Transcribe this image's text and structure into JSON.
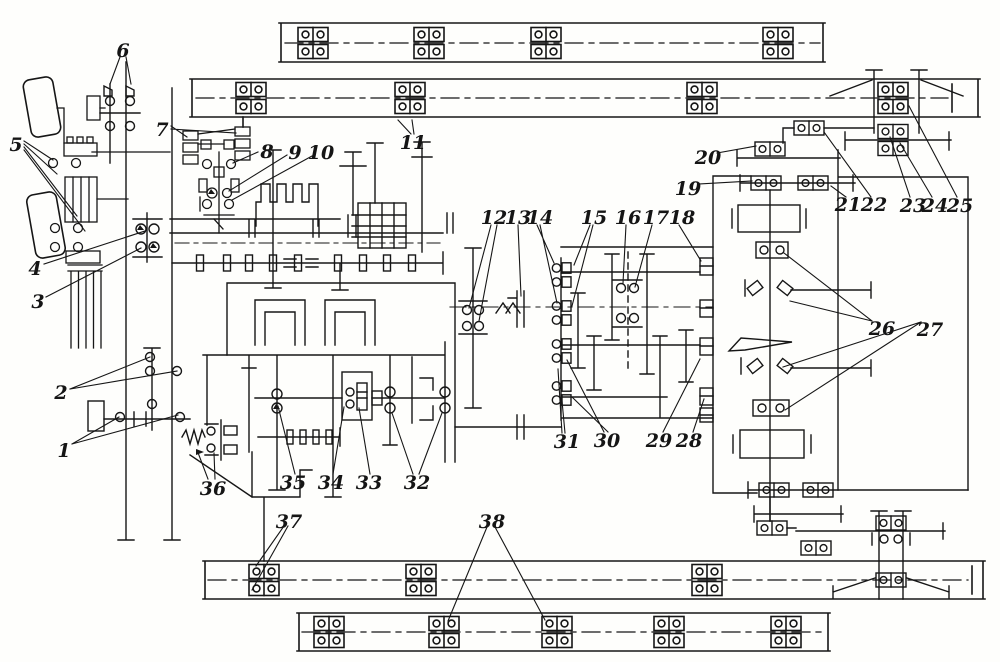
{
  "figure": {
    "kind": "kinematic-scheme-line-drawing",
    "ink_color": "#161616",
    "paper_color": "#fefefc",
    "callout_count": 38
  },
  "callouts": [
    "1",
    "2",
    "3",
    "4",
    "5",
    "6",
    "7",
    "8",
    "9",
    "10",
    "11",
    "12",
    "13",
    "14",
    "15",
    "16",
    "17",
    "18",
    "19",
    "20",
    "21",
    "22",
    "23",
    "24",
    "25",
    "26",
    "27",
    "28",
    "29",
    "30",
    "31",
    "32",
    "33",
    "34",
    "35",
    "36",
    "37",
    "38"
  ]
}
